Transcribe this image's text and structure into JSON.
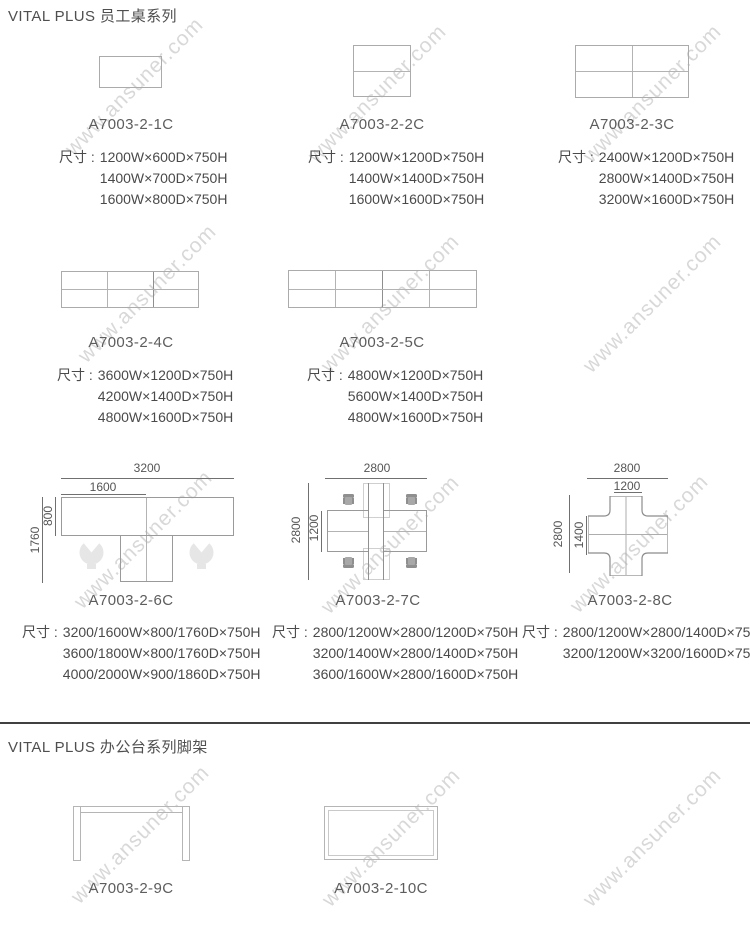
{
  "page": {
    "watermark": "www.ansuner.com"
  },
  "size_prefix": "尺寸 :",
  "sections": [
    {
      "title": "VITAL PLUS  员工桌系列"
    },
    {
      "title": "VITAL PLUS  办公台系列脚架"
    }
  ],
  "products": [
    {
      "code": "A7003-2-1C",
      "specs": [
        "1200W×600D×750H",
        "1400W×700D×750H",
        "1600W×800D×750H"
      ]
    },
    {
      "code": "A7003-2-2C",
      "specs": [
        "1200W×1200D×750H",
        "1400W×1400D×750H",
        "1600W×1600D×750H"
      ]
    },
    {
      "code": "A7003-2-3C",
      "specs": [
        "2400W×1200D×750H",
        "2800W×1400D×750H",
        "3200W×1600D×750H"
      ]
    },
    {
      "code": "A7003-2-4C",
      "specs": [
        "3600W×1200D×750H",
        "4200W×1400D×750H",
        "4800W×1600D×750H"
      ]
    },
    {
      "code": "A7003-2-5C",
      "specs": [
        "4800W×1200D×750H",
        "5600W×1400D×750H",
        "4800W×1600D×750H"
      ]
    },
    {
      "code": "A7003-2-6C",
      "specs": [
        "3200/1600W×800/1760D×750H",
        "3600/1800W×800/1760D×750H",
        "4000/2000W×900/1860D×750H"
      ],
      "dims": {
        "outer_w": "3200",
        "inner_w": "1600",
        "outer_d": "1760",
        "inner_d": "800"
      }
    },
    {
      "code": "A7003-2-7C",
      "specs": [
        "2800/1200W×2800/1200D×750H",
        "3200/1400W×2800/1400D×750H",
        "3600/1600W×2800/1600D×750H"
      ],
      "dims": {
        "outer_w": "2800",
        "outer_d": "2800",
        "inner_d": "1200"
      }
    },
    {
      "code": "A7003-2-8C",
      "specs": [
        "2800/1200W×2800/1400D×750H",
        "3200/1200W×3200/1600D×750H"
      ],
      "dims": {
        "outer_w": "2800",
        "inner_w": "1200",
        "outer_d": "2800",
        "inner_d": "1400"
      }
    },
    {
      "code": "A7003-2-9C",
      "specs": []
    },
    {
      "code": "A7003-2-10C",
      "specs": []
    }
  ]
}
